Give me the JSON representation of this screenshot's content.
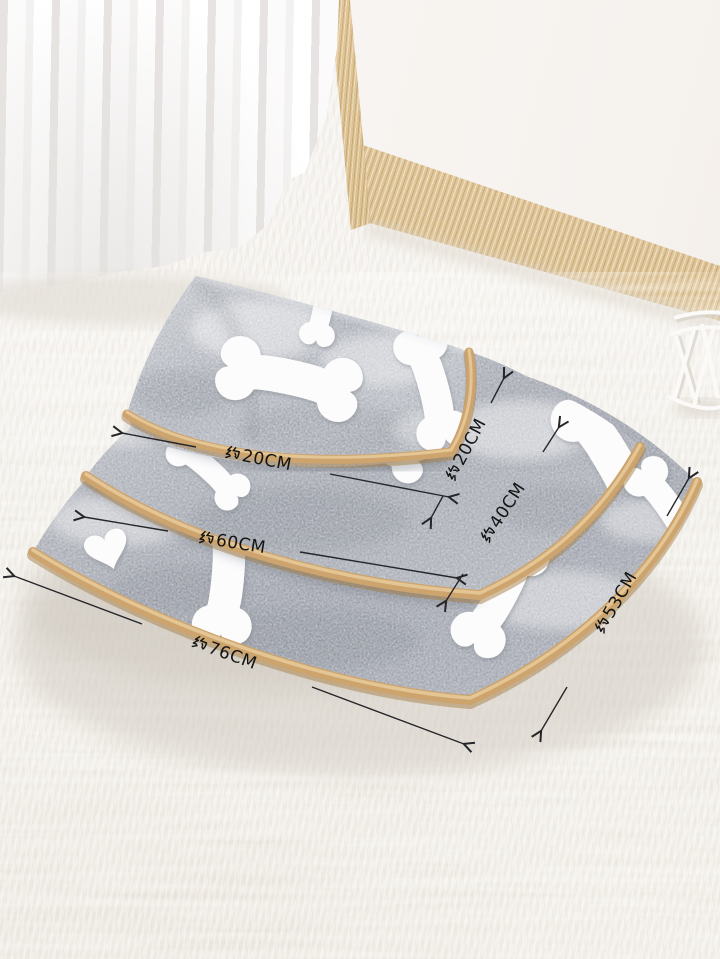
{
  "scene": {
    "alt": "Three grey fleece pet blankets with white bone and heart prints, tan binding, stacked by size on a white shag rug in front of a sheer curtain and a wood-trimmed white board; black dimension arrows give approximate sizes"
  },
  "palette": {
    "blanket_grey": "#a8acb4",
    "trim_tan": "#cda46e",
    "bone_white": "#fcfcfd",
    "rug_white": "#f1eee9",
    "wood": "#d9bd8f",
    "annotation_black": "#141414"
  },
  "annotations": [
    {
      "id": "width-small",
      "label": "约20CM",
      "prefix": "约",
      "value": "20CM",
      "orientation": "horizontal"
    },
    {
      "id": "depth-small",
      "label": "约20CM",
      "prefix": "约",
      "value": "20CM",
      "orientation": "diagonal"
    },
    {
      "id": "depth-medium",
      "label": "约40CM",
      "prefix": "约",
      "value": "40CM",
      "orientation": "diagonal"
    },
    {
      "id": "width-medium",
      "label": "约60CM",
      "prefix": "约",
      "value": "60CM",
      "orientation": "horizontal"
    },
    {
      "id": "width-large",
      "label": "约76CM",
      "prefix": "约",
      "value": "76CM",
      "orientation": "horizontal"
    },
    {
      "id": "depth-large",
      "label": "约53CM",
      "prefix": "约",
      "value": "53CM",
      "orientation": "diagonal"
    }
  ]
}
